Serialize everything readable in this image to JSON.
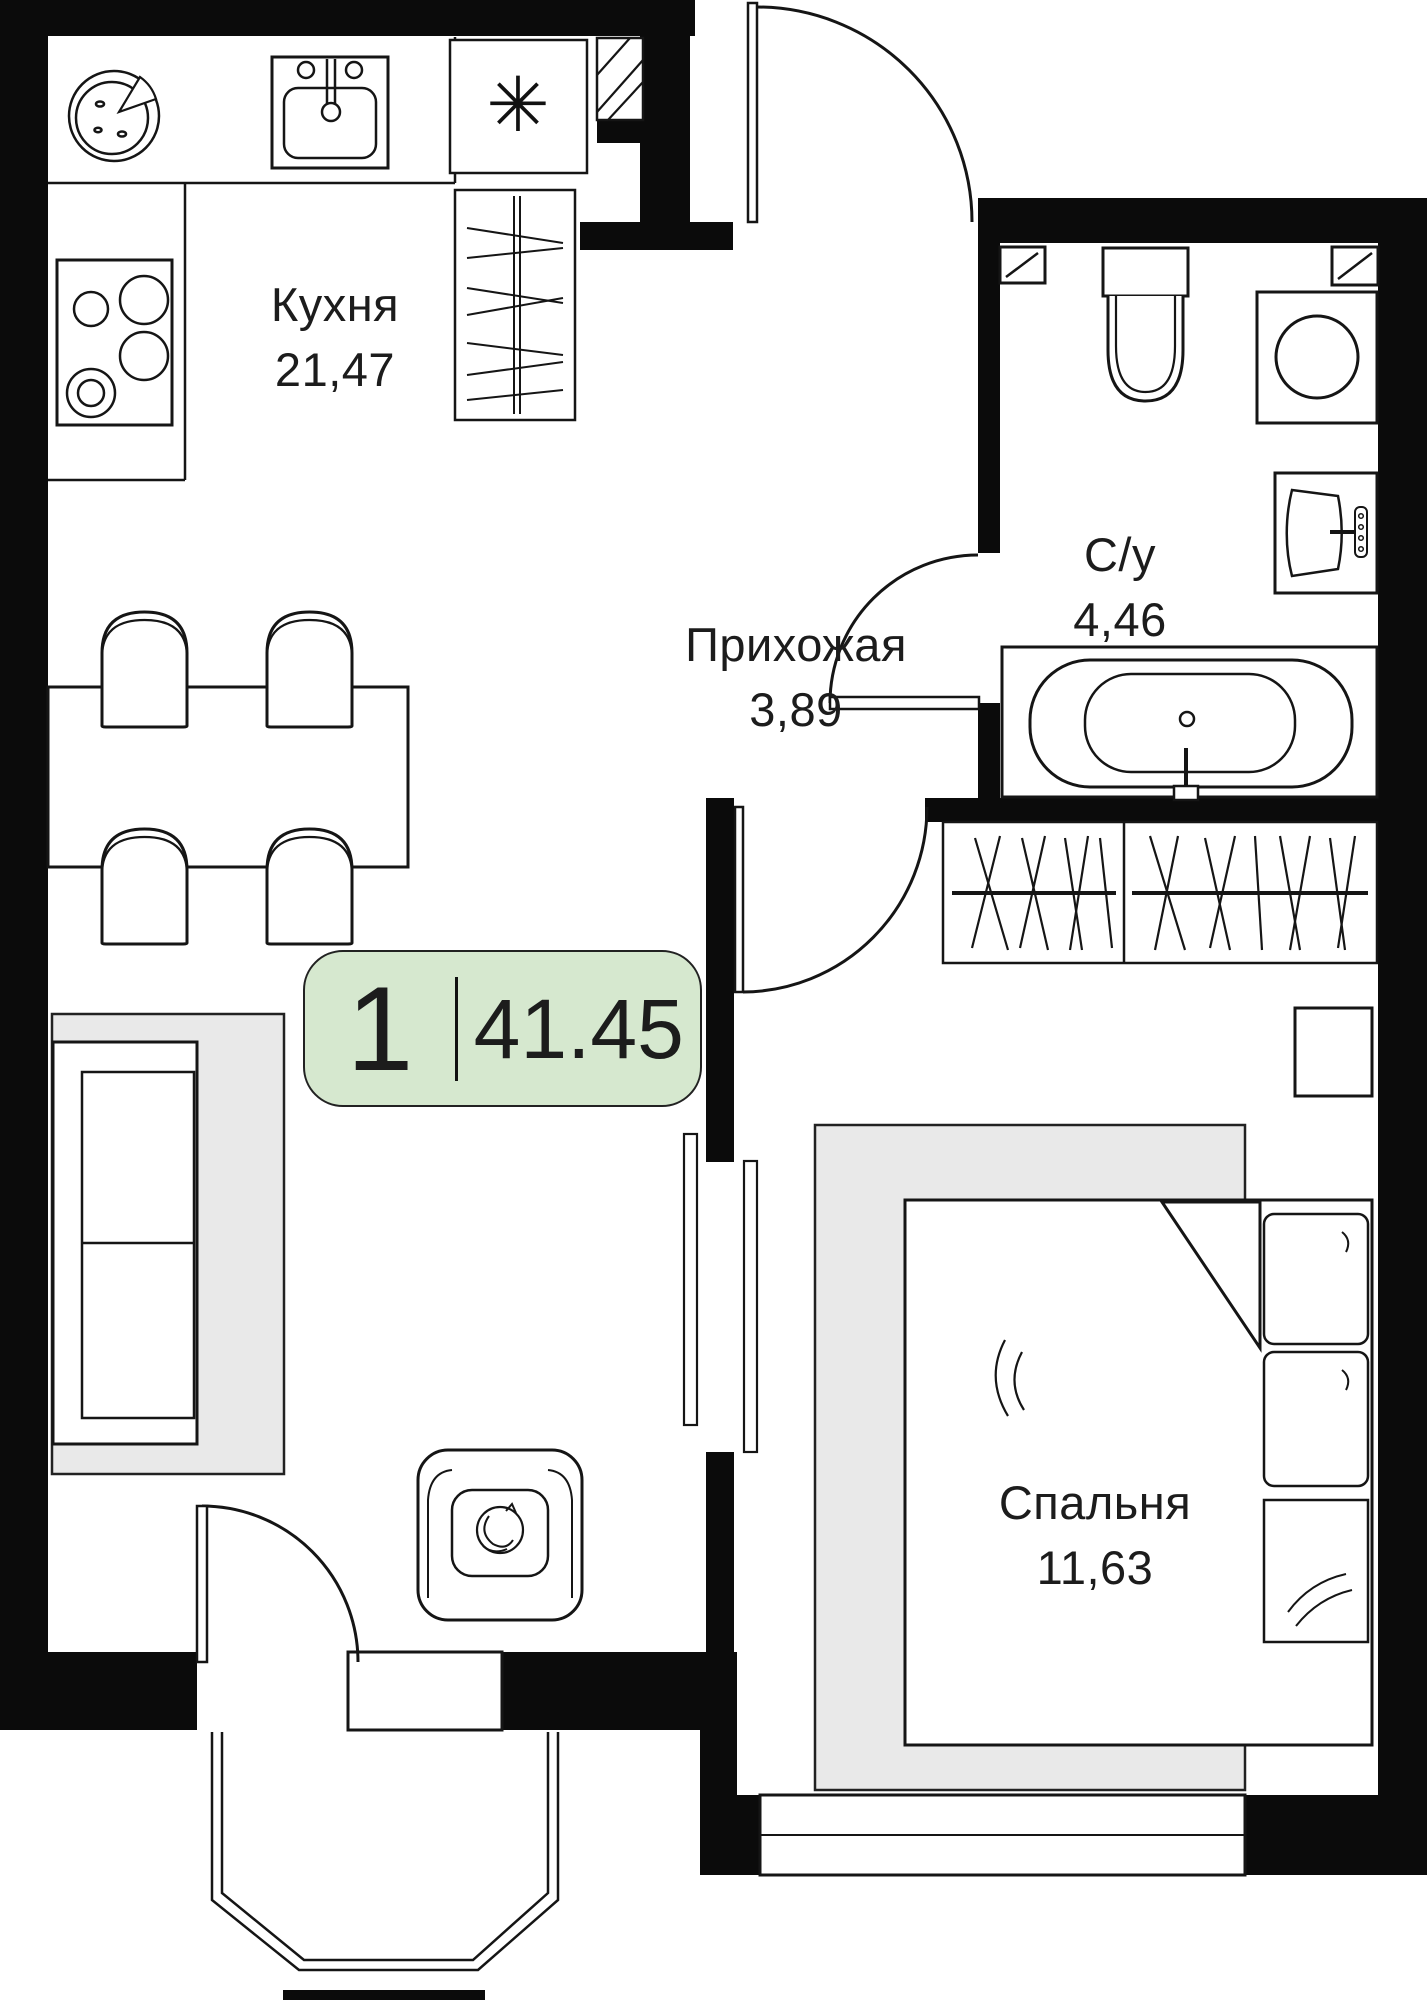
{
  "badge": {
    "rooms": "1",
    "area": "41.45"
  },
  "rooms": [
    {
      "id": "kitchen",
      "name": "Кухня",
      "area": "21,47"
    },
    {
      "id": "hallway",
      "name": "Прихожая",
      "area": "3,89"
    },
    {
      "id": "bathroom",
      "name": "С/у",
      "area": "4,46"
    },
    {
      "id": "bedroom",
      "name": "Спальня",
      "area": "11,63"
    }
  ],
  "fridge_symbol": "✳",
  "colors": {
    "badge_bg": "#d6e8cf",
    "wall": "#0b0b0b",
    "stroke": "#151515",
    "rug": "#e9e9e9",
    "paper": "#ffffff"
  }
}
